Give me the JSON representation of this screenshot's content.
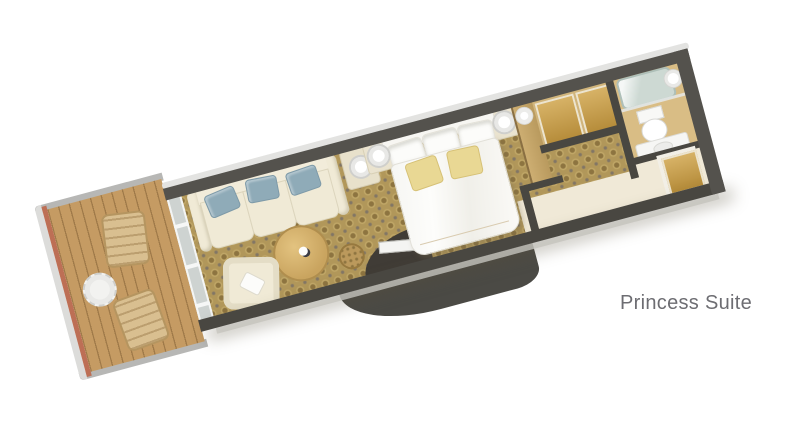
{
  "title": {
    "label": "Princess Suite"
  },
  "colors": {
    "wall": "#54524d",
    "wall_dark": "#494741",
    "hull_light": "#e3e3e1",
    "carpet_base": "#b1975a",
    "deck": "#c59b63",
    "hull_salmon": "#bd6f55",
    "glass": "#ced3d1",
    "cream": "#f0ead6",
    "pillow_blue": "#8fabb8",
    "wood_gold": "#c99d45",
    "tan_floor": "#d0b47b",
    "bath_floor": "#d9bd85",
    "tub": "#cdd9d3",
    "white": "#fbfbf9",
    "gold_pillow": "#e9d894",
    "divider_wood": "#c2a266",
    "entry_floor": "#f0e9d7",
    "dark_mass": "#4b4a45",
    "label_text": "#6d6d72"
  }
}
